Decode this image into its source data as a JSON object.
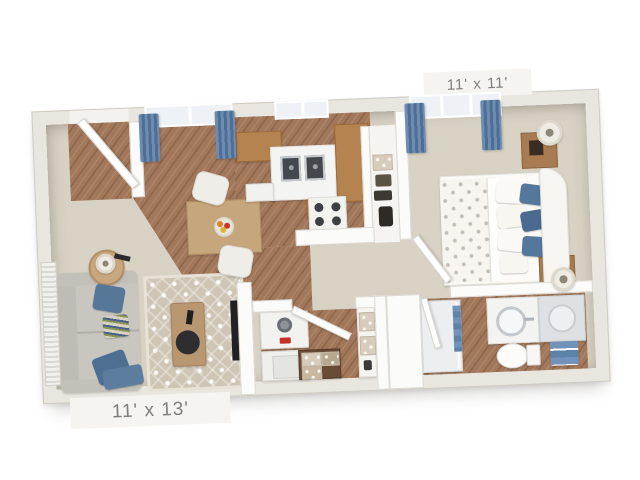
{
  "floorplan": {
    "bedroom_label": "11' x 11'",
    "living_label": "11' x 13'",
    "rooms": [
      "living-dining",
      "kitchen",
      "entry",
      "closet",
      "bedroom",
      "laundry",
      "bathroom",
      "hallway"
    ],
    "colors": {
      "wall": "#e9e6e0",
      "wall_edge": "#cfcbc3",
      "carpet": "#d8d2c5",
      "wood": "#a2775a",
      "wood_dark": "#8a6349",
      "cabinet": "#b5834f",
      "rug": "#cfc5b5",
      "sofa": "#c9c6c0",
      "accent_blue": "#587899",
      "curtain_blue": "#6384ab",
      "towel_blue": "#7193bb",
      "white_furn": "#fbfaf7",
      "label_bg": "#f5f4f1",
      "label_text": "#7e7e7e",
      "background": "#ffffff"
    }
  }
}
